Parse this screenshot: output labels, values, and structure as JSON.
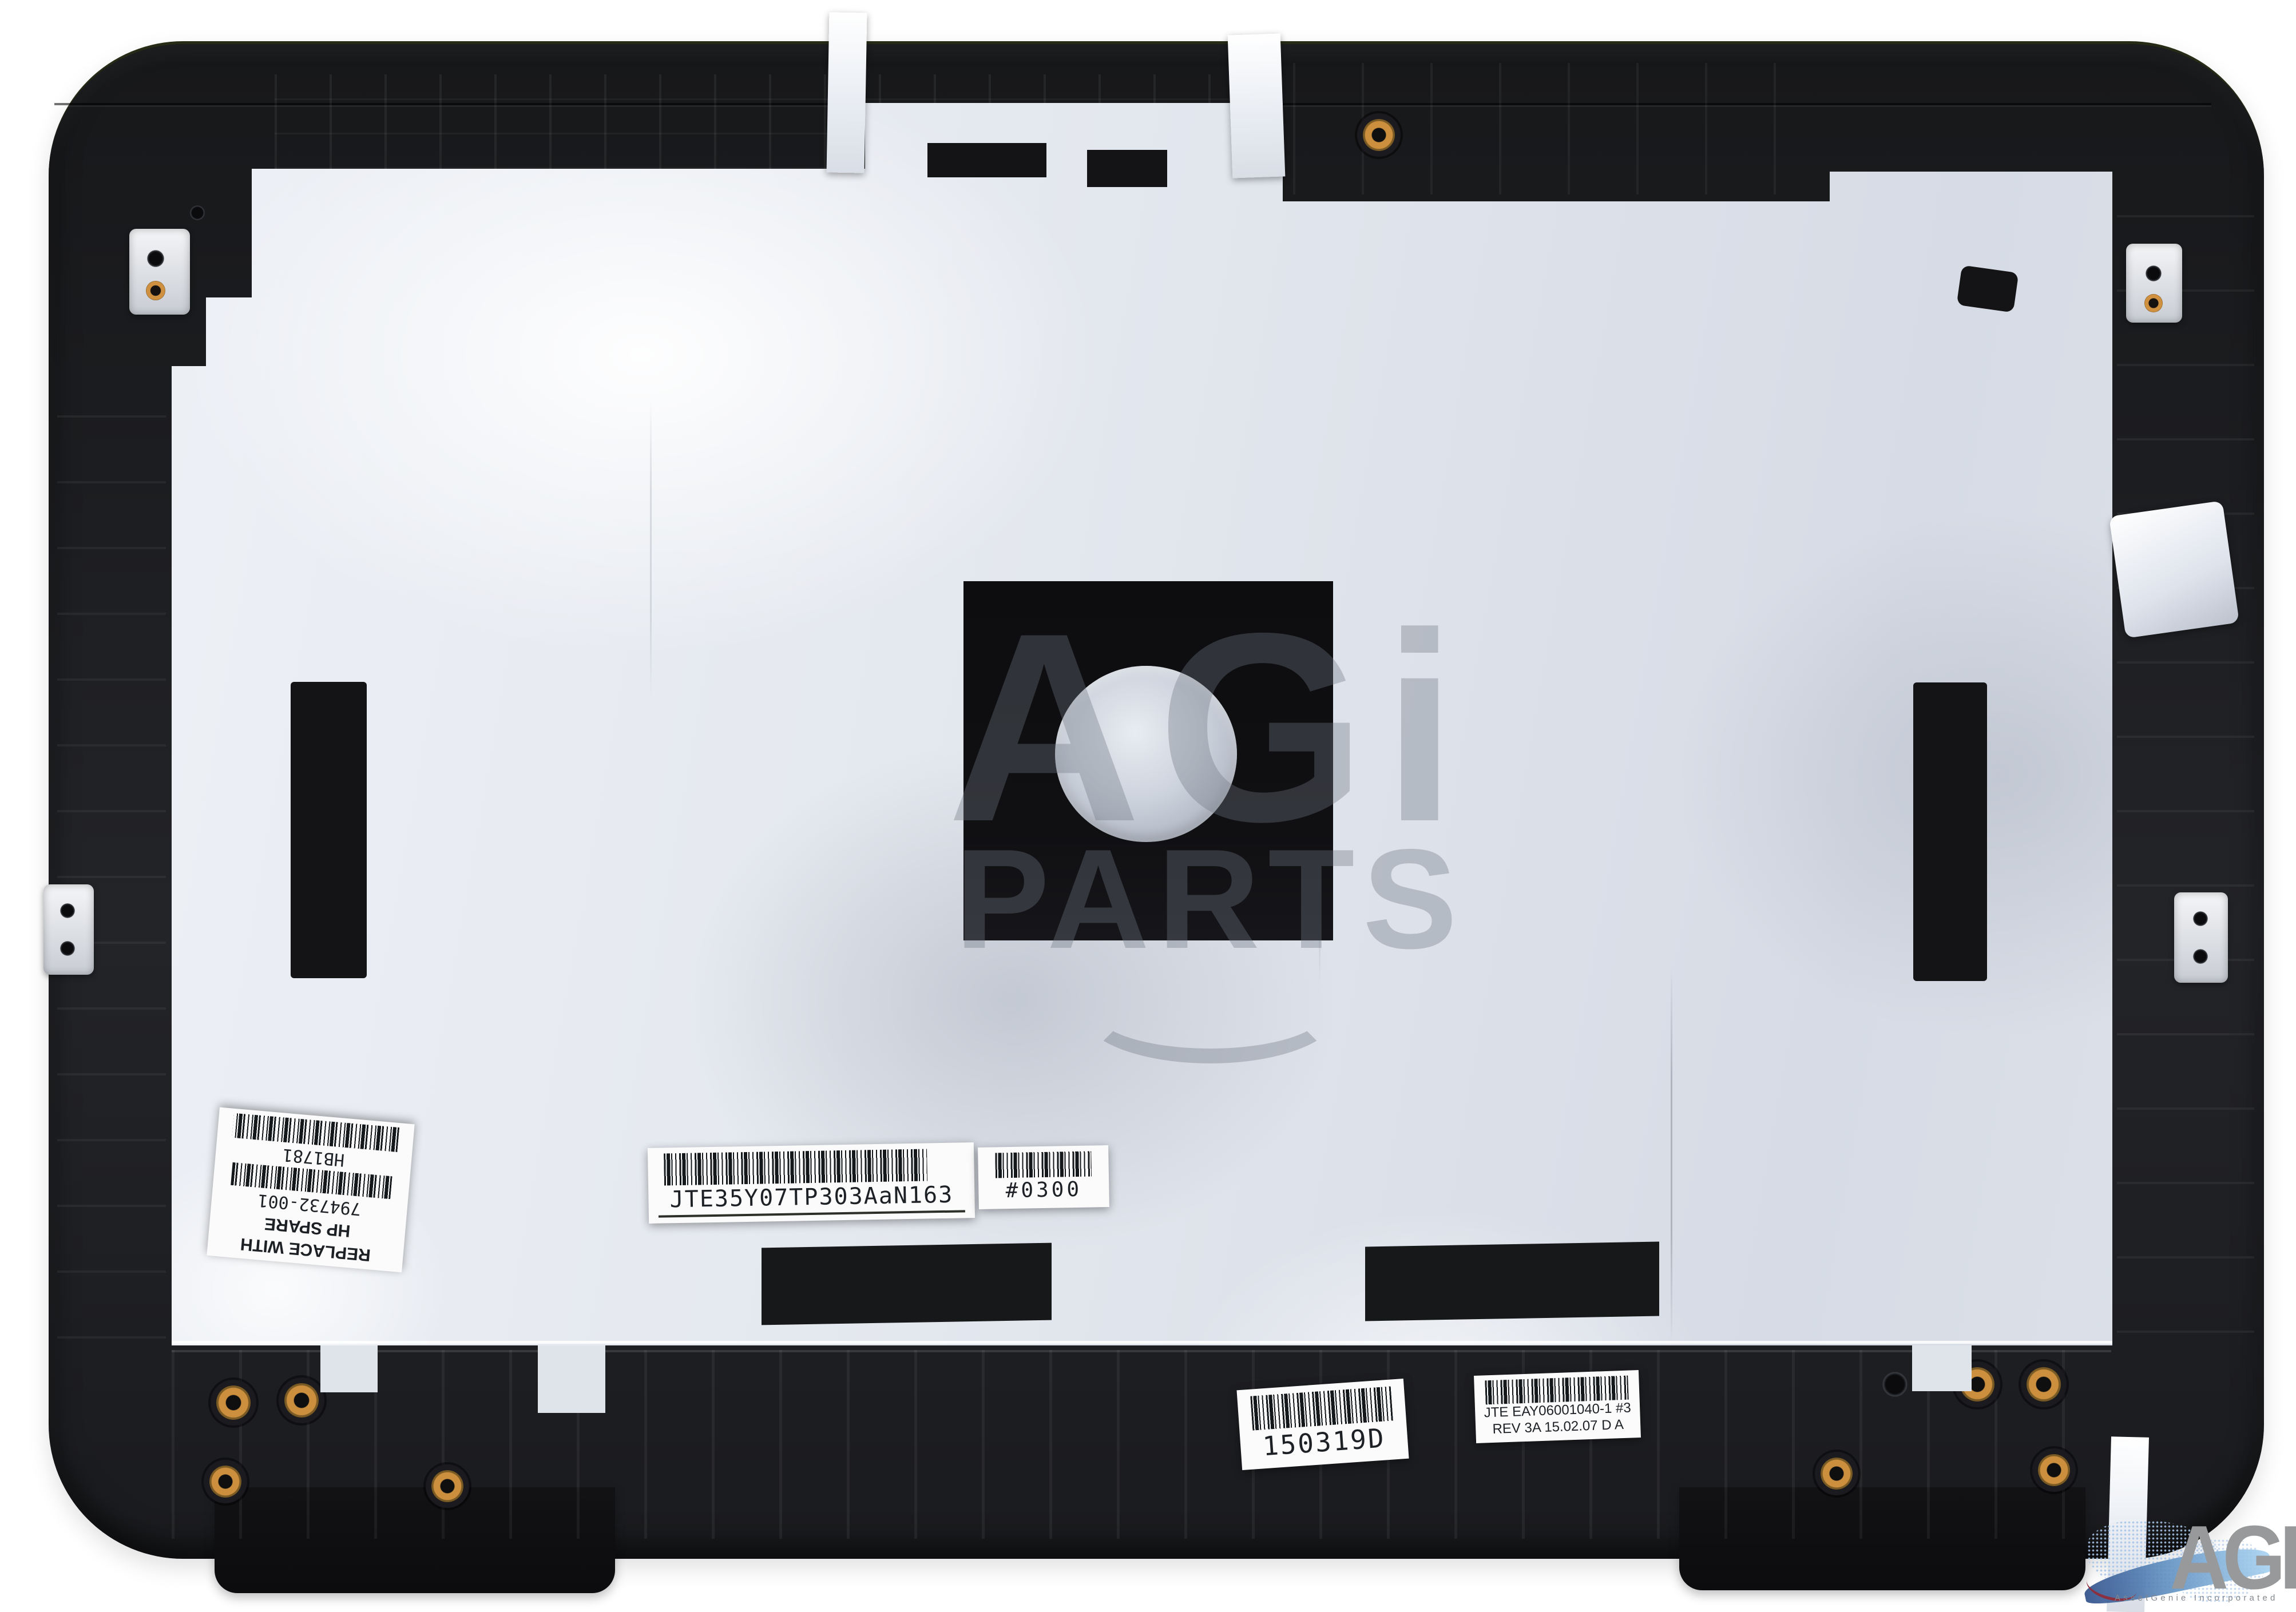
{
  "labels": {
    "hp_spare": {
      "line1": "REPLACE WITH",
      "line2": "HP SPARE",
      "part_number": "794732-001",
      "code": "HB1781"
    },
    "serial": {
      "code": "JTE35Y07TP303AaN163"
    },
    "bin": {
      "code": "#0300"
    },
    "date": {
      "code": "150319D"
    },
    "rev": {
      "line1": "JTE EAY06001040-1 #3",
      "line2": "REV 3A 15.02.07 D A"
    }
  },
  "watermark": {
    "line1": "AGi",
    "line2": "PARTS"
  },
  "logo": {
    "name": "AGI",
    "tagline": "AssetGenie Incorporated"
  },
  "colors": {
    "background": "#ffffff",
    "plastic": "#1a1a1c",
    "foil": "#e3e7ee",
    "brass": "#cb8f3d",
    "watermark_gray": "#6e7682",
    "logo_gray": "#97999b",
    "logo_blue": "#a9c5e7",
    "logo_red": "#8c3040"
  }
}
